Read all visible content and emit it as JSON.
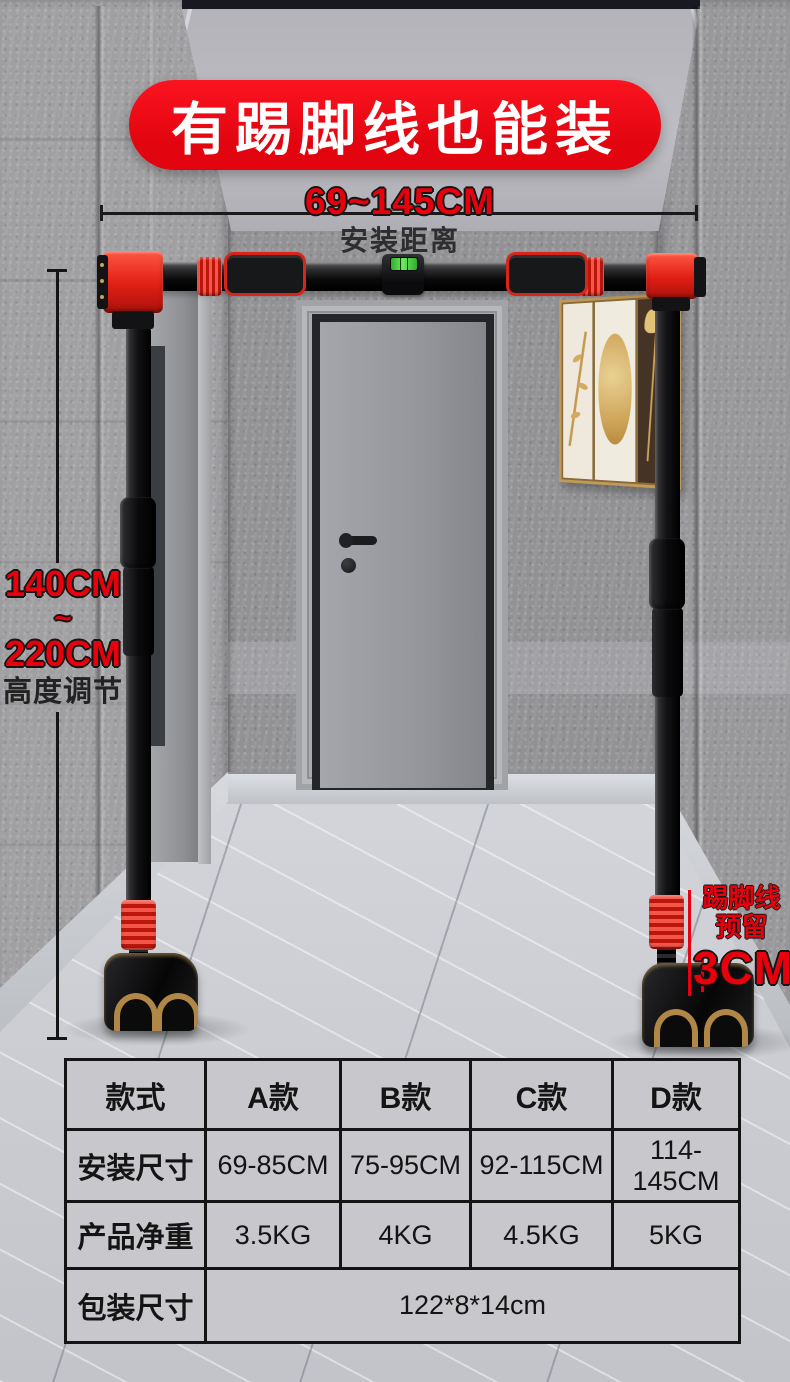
{
  "banner": {
    "title": "有踢脚线也能装"
  },
  "measurements": {
    "width": {
      "value": "69~145CM",
      "label": "安装距离"
    },
    "height": {
      "min": "140CM",
      "separator": "~",
      "max": "220CM",
      "label": "高度调节"
    },
    "skirting": {
      "name": "踢脚线",
      "note": "预留",
      "value": "3CM"
    }
  },
  "spec_table": {
    "headers": [
      "款式",
      "A款",
      "B款",
      "C款",
      "D款"
    ],
    "rows": [
      {
        "label": "安装尺寸",
        "values": [
          "69-85CM",
          "75-95CM",
          "92-115CM",
          "114-145CM"
        ]
      },
      {
        "label": "产品净重",
        "values": [
          "3.5KG",
          "4KG",
          "4.5KG",
          "5KG"
        ]
      },
      {
        "label": "包装尺寸",
        "merged_value": "122*8*14cm"
      }
    ]
  },
  "colors": {
    "banner_red": "#ee0a12",
    "accent_red": "#e60012",
    "product_red": "#e8251c",
    "level_green": "#4fc542",
    "table_bg": "#c8c8cc",
    "line_black": "#1a1a1a"
  }
}
